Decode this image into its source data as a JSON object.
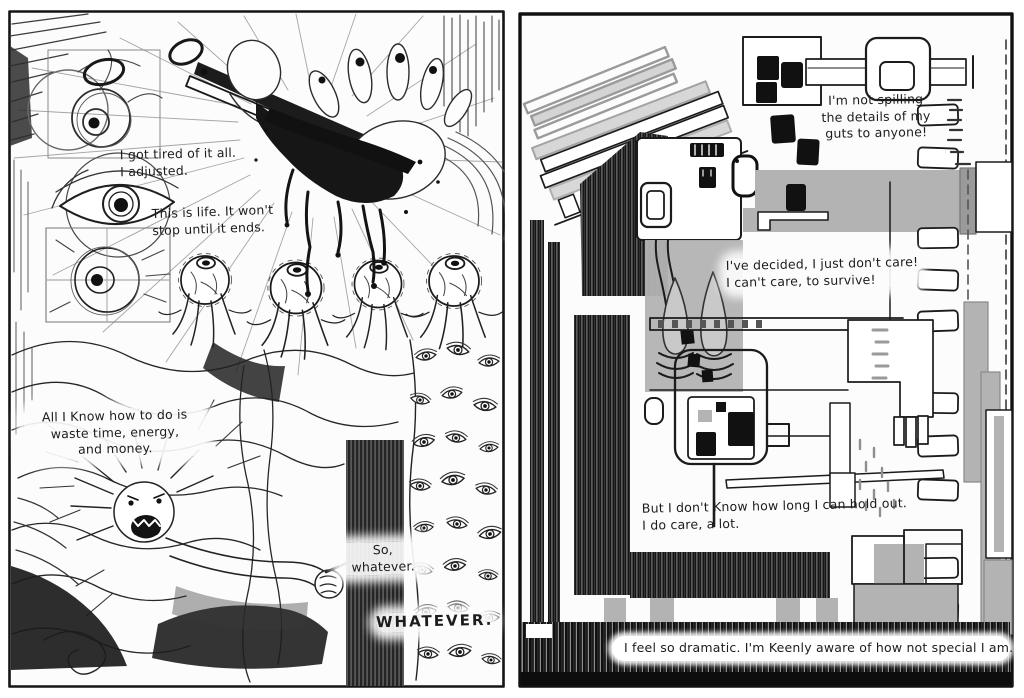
{
  "palette": {
    "paper": "#fcfcfc",
    "ink": "#1a1a1a",
    "pencil_gray": "#b3b3b3"
  },
  "left": {
    "captions": {
      "tired": {
        "lines": [
          "I got tired of it all.",
          "I adjusted."
        ]
      },
      "life": {
        "lines": [
          "This is life. It won't",
          "stop until it ends."
        ]
      },
      "waste": {
        "lines": [
          "All I Know how to do is",
          "waste time, energy,",
          "and money."
        ]
      },
      "so_whatever": {
        "lines": [
          "So,",
          "whatever."
        ]
      },
      "whatever": {
        "lines": [
          "WHATEVER."
        ]
      }
    }
  },
  "right": {
    "captions": {
      "spilling": {
        "lines": [
          "I'm not spilling",
          "the details of my",
          "guts to anyone!"
        ]
      },
      "decided": {
        "lines": [
          "I've decided, I just don't care!",
          "I can't care, to survive!"
        ]
      },
      "hold_out": {
        "lines": [
          "But I don't Know how long I can hold out.",
          "I do care, a lot."
        ]
      },
      "dramatic": {
        "lines": [
          "I feel so dramatic. I'm Keenly aware of how not special I am."
        ]
      }
    }
  }
}
